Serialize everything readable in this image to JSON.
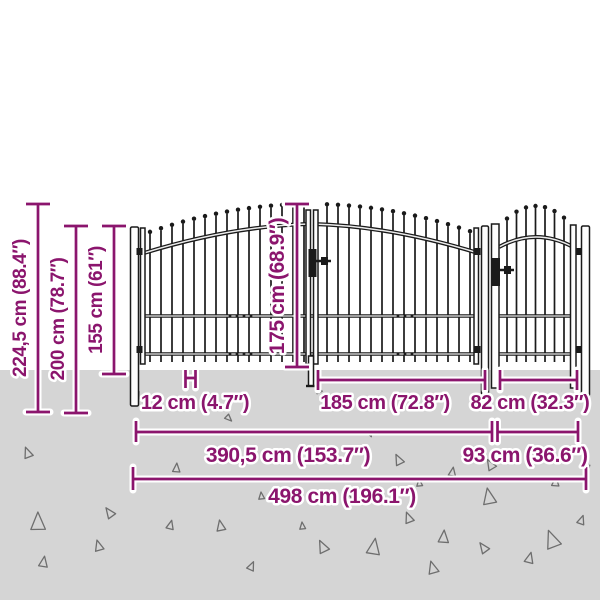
{
  "title": "Garden gate dimension diagram",
  "colors": {
    "accent": "#8B156D",
    "ground": "#D5D5D5",
    "sky": "#FFFFFF",
    "fence_ink": "#1A1A1A"
  },
  "dimensions": {
    "overall_height": "224,5 cm (88.4″)",
    "post_height": "200 cm (78.7″)",
    "fence_height": "155 cm (61″)",
    "gate_leaf_height": "175 cm (68.9″)",
    "post_width": "12 cm (4.7″)",
    "gate_leaf_width": "185 cm (72.8″)",
    "single_leaf_width": "82 cm (32.3″)",
    "double_gate_width": "390,5 cm (153.7″)",
    "single_gate_width": "93 cm (36.6″)",
    "overall_width": "498 cm (196.1″)"
  }
}
